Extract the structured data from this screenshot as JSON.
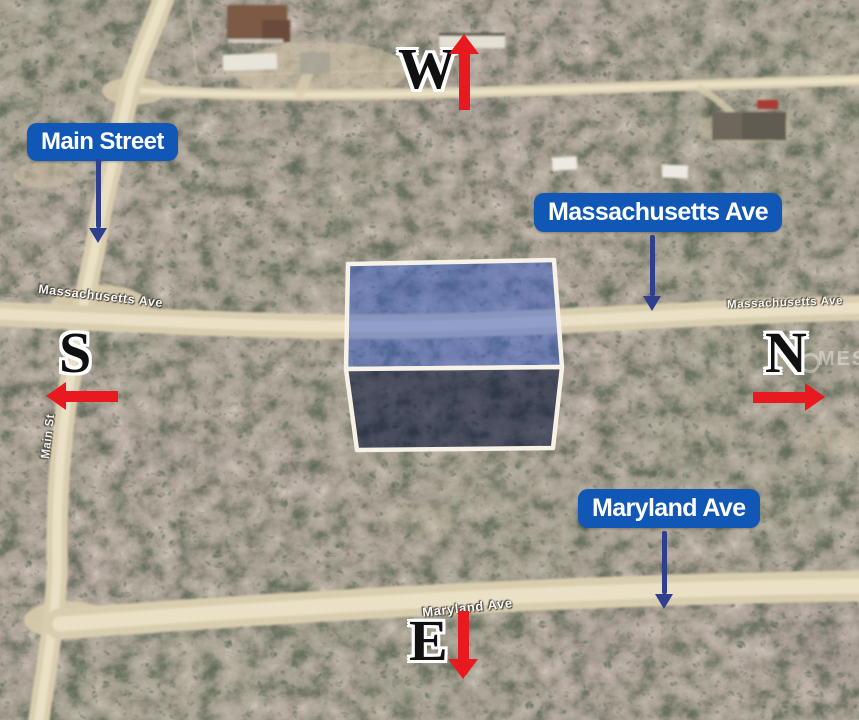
{
  "colors": {
    "label-blue": "#1157b6",
    "label-text": "#ffffff",
    "nav-arrow": "#2e3f8e",
    "red-arrow": "#e8191f",
    "compass-ink": "#101010",
    "map-text": "#ffffff",
    "road-sand": "#d9cdaf",
    "road-core": "#e9e0c6",
    "parcel-top": "rgba(48,88,205,0.48)",
    "parcel-front": "rgba(9,20,55,0.60)",
    "parcel-stroke": "#f6f2e8"
  },
  "annotations": {
    "street_pills": [
      {
        "id": "main-street",
        "label": "Main Street"
      },
      {
        "id": "massachusetts-ave",
        "label": "Massachusetts Ave"
      },
      {
        "id": "maryland-ave",
        "label": "Maryland Ave"
      }
    ],
    "compass": {
      "west": "W",
      "south": "S",
      "north": "N",
      "east": "E"
    }
  },
  "map_text": {
    "massachusetts_left": "Massachusetts Ave",
    "massachusetts_right": "Massachusetts Ave",
    "maryland": "Maryland Ave",
    "main_st_vertical": "Main St",
    "watermark": "MES"
  }
}
